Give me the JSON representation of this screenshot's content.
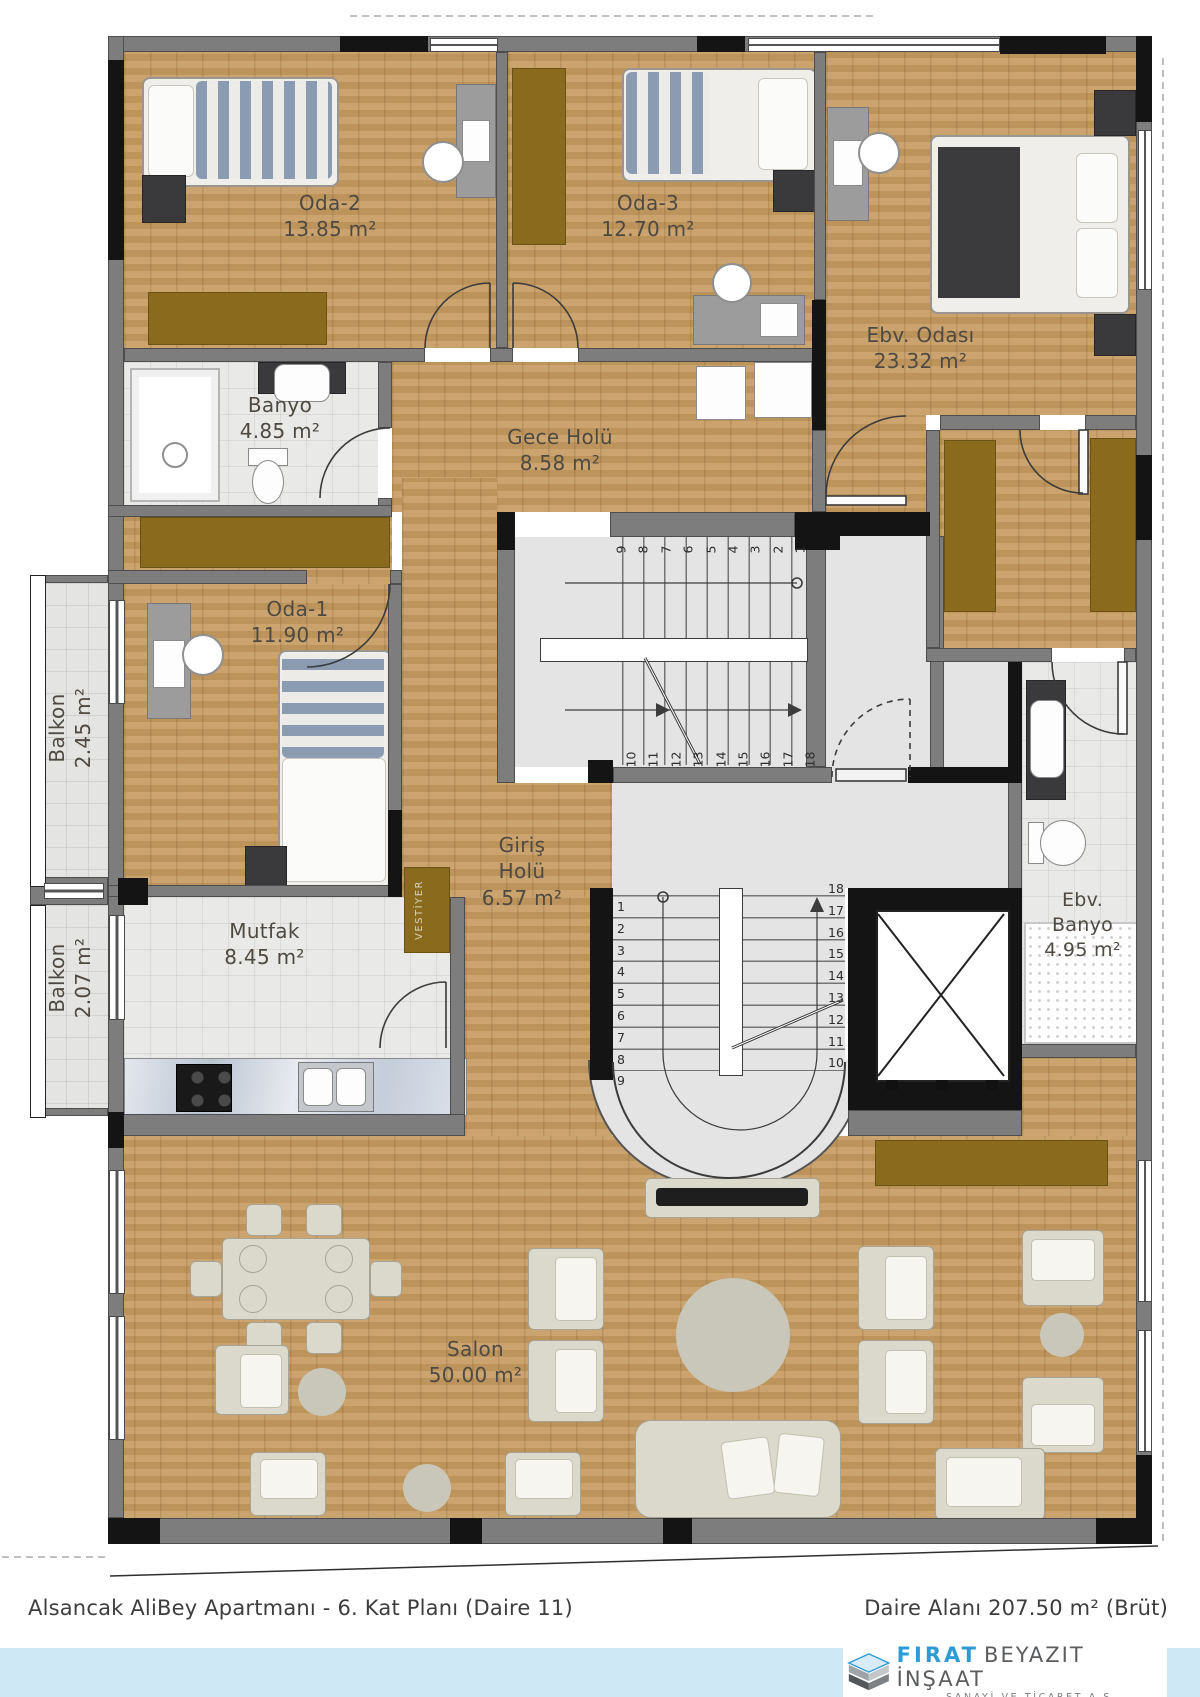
{
  "plan": {
    "rooms": [
      {
        "name": "Oda-2",
        "area": "13.85 m²"
      },
      {
        "name": "Oda-3",
        "area": "12.70 m²"
      },
      {
        "name": "Ebv. Odası",
        "area": "23.32 m²"
      },
      {
        "name": "Banyo",
        "area": "4.85 m²"
      },
      {
        "name": "Gece Holü",
        "area": "8.58 m²"
      },
      {
        "name": "Oda-1",
        "area": "11.90 m²"
      },
      {
        "name": "Balkon",
        "area": "2.45 m²"
      },
      {
        "name": "Balkon",
        "area": "2.07 m²"
      },
      {
        "name": "Mutfak",
        "area": "8.45 m²"
      },
      {
        "name": "Giriş Holü",
        "area": "6.57 m²"
      },
      {
        "name": "Ebv. Banyo",
        "area": "4.95 m²"
      },
      {
        "name": "Salon",
        "area": "50.00 m²"
      }
    ],
    "vestiyer_label": "VESTİYER",
    "stairs": {
      "upper_top": [
        "9",
        "8",
        "7",
        "6",
        "5",
        "4",
        "3",
        "2",
        "1"
      ],
      "upper_bottom": [
        "10",
        "11",
        "12",
        "13",
        "14",
        "15",
        "16",
        "17",
        "18"
      ],
      "lower_left": [
        "1",
        "2",
        "3",
        "4",
        "5",
        "6",
        "7",
        "8",
        "9"
      ],
      "lower_right": [
        "18",
        "17",
        "16",
        "15",
        "14",
        "13",
        "12",
        "11",
        "10"
      ]
    }
  },
  "footer": {
    "title_left": "Alsancak AliBey Apartmanı - 6. Kat Planı (Daire 11)",
    "title_right": "Daire Alanı 207.50 m² (Brüt)",
    "logo": {
      "brand": "FIRAT",
      "brand2": "BEYAZIT İNŞAAT",
      "sub": "SANAYİ VE TİCARET A.Ş."
    }
  },
  "colors": {
    "wood": "#c59b62",
    "wall": "#7d7d7d",
    "wall_dark": "#141414",
    "wardrobe": "#8a6b1e",
    "accent_blue": "#2e9bd5",
    "band_blue": "#cfe8f6"
  }
}
